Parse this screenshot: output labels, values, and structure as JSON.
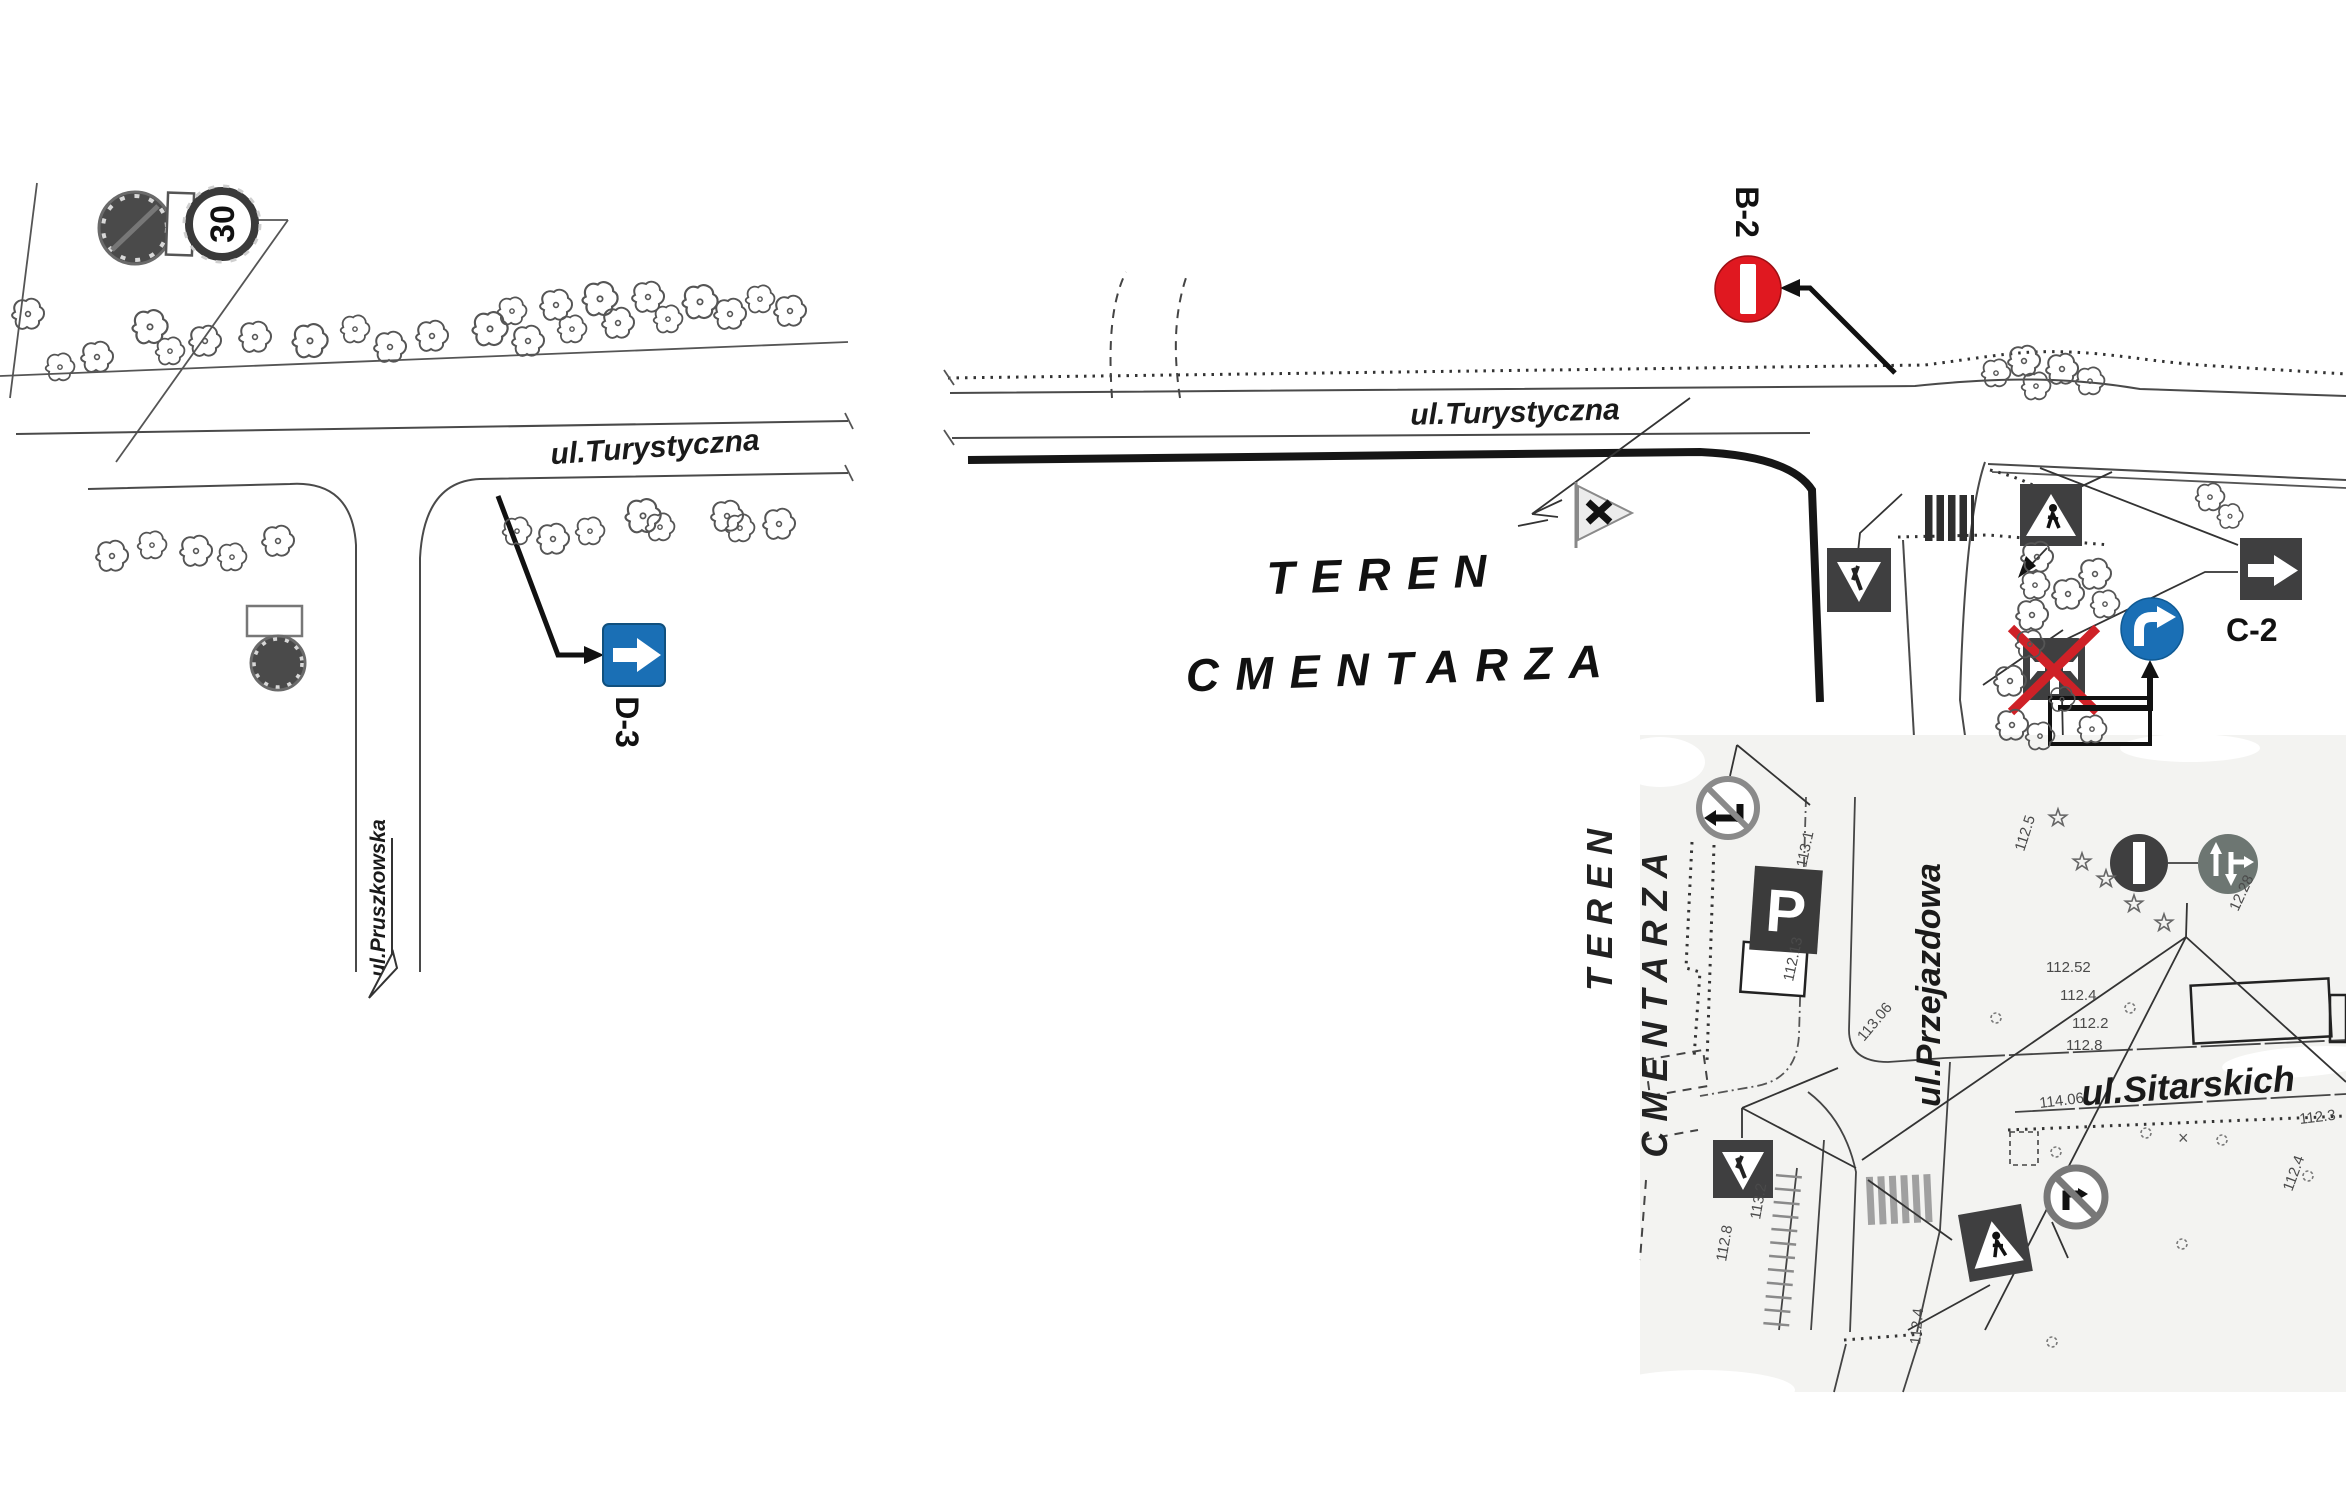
{
  "streets": {
    "turystyczna_left": "ul.Turystyczna",
    "turystyczna_right": "ul.Turystyczna",
    "pruszkowska": "ul.Pruszkowska",
    "przejazdowa": "ul.Przejazdowa",
    "sitarskich": "ul.Sitarskich"
  },
  "area": {
    "line1": "TEREN",
    "line2": "CMENTARZA"
  },
  "inset_area": {
    "line1": "TEREN",
    "line2": "CMENTARZA"
  },
  "signs": {
    "d3": {
      "code": "D-3"
    },
    "b2": {
      "code": "B-2"
    },
    "c2": {
      "code": "C-2"
    },
    "speed": {
      "value": "30"
    },
    "parking": {
      "letter": "P"
    }
  },
  "colors": {
    "sign_blue": "#1a6fb5",
    "sign_red": "#e01820",
    "cross_red": "#cf2127",
    "dark_sign": "#3f3f40",
    "grey_sign": "#6d7672"
  },
  "elevations": [
    {
      "t": "113.1",
      "x": 1806,
      "y": 868,
      "r": -78
    },
    {
      "t": "112.13",
      "x": 1793,
      "y": 982,
      "r": -78
    },
    {
      "t": "113.06",
      "x": 1864,
      "y": 1042,
      "r": -50
    },
    {
      "t": "112.5",
      "x": 2024,
      "y": 852,
      "r": -72
    },
    {
      "t": "12.28",
      "x": 2238,
      "y": 912,
      "r": -65
    },
    {
      "t": "112.52",
      "x": 2046,
      "y": 972,
      "r": 0
    },
    {
      "t": "112.4",
      "x": 2060,
      "y": 1000,
      "r": 0
    },
    {
      "t": "112.2",
      "x": 2072,
      "y": 1028,
      "r": 0
    },
    {
      "t": "112.8",
      "x": 2066,
      "y": 1050,
      "r": 0
    },
    {
      "t": "114.06",
      "x": 2040,
      "y": 1108,
      "r": -7
    },
    {
      "t": "112.3",
      "x": 2300,
      "y": 1124,
      "r": -7
    },
    {
      "t": "112.4",
      "x": 2292,
      "y": 1192,
      "r": -70
    },
    {
      "t": "112.8",
      "x": 1726,
      "y": 1262,
      "r": -80
    },
    {
      "t": "113.2",
      "x": 1760,
      "y": 1220,
      "r": -80
    },
    {
      "t": "112.4",
      "x": 1920,
      "y": 1345,
      "r": -85
    }
  ],
  "stars": [
    {
      "x": 2058,
      "y": 818
    },
    {
      "x": 2082,
      "y": 862
    },
    {
      "x": 2106,
      "y": 879
    },
    {
      "x": 2134,
      "y": 904
    },
    {
      "x": 2164,
      "y": 923
    }
  ],
  "bushes": [
    {
      "x": 2130,
      "y": 1008
    },
    {
      "x": 1996,
      "y": 1018
    },
    {
      "x": 2146,
      "y": 1133
    },
    {
      "x": 2222,
      "y": 1140
    },
    {
      "x": 2056,
      "y": 1152
    },
    {
      "x": 2308,
      "y": 1176
    },
    {
      "x": 2182,
      "y": 1244
    },
    {
      "x": 2052,
      "y": 1342
    }
  ],
  "xmarks": [
    {
      "x": 2178,
      "y": 1144
    }
  ],
  "trees": [
    {
      "x": 28,
      "y": 315,
      "s": 1.0
    },
    {
      "x": 60,
      "y": 368,
      "s": 0.9
    },
    {
      "x": 97,
      "y": 358,
      "s": 1.0
    },
    {
      "x": 150,
      "y": 328,
      "s": 1.1
    },
    {
      "x": 170,
      "y": 352,
      "s": 0.9
    },
    {
      "x": 205,
      "y": 342,
      "s": 1.0
    },
    {
      "x": 255,
      "y": 338,
      "s": 1.0
    },
    {
      "x": 310,
      "y": 342,
      "s": 1.1
    },
    {
      "x": 355,
      "y": 330,
      "s": 0.9
    },
    {
      "x": 390,
      "y": 348,
      "s": 1.0
    },
    {
      "x": 432,
      "y": 337,
      "s": 1.0
    },
    {
      "x": 490,
      "y": 330,
      "s": 1.1
    },
    {
      "x": 512,
      "y": 312,
      "s": 0.9
    },
    {
      "x": 528,
      "y": 342,
      "s": 1.0
    },
    {
      "x": 556,
      "y": 306,
      "s": 1.0
    },
    {
      "x": 572,
      "y": 330,
      "s": 0.9
    },
    {
      "x": 600,
      "y": 300,
      "s": 1.1
    },
    {
      "x": 618,
      "y": 324,
      "s": 1.0
    },
    {
      "x": 648,
      "y": 298,
      "s": 1.0
    },
    {
      "x": 668,
      "y": 320,
      "s": 0.9
    },
    {
      "x": 700,
      "y": 303,
      "s": 1.1
    },
    {
      "x": 730,
      "y": 315,
      "s": 1.0
    },
    {
      "x": 760,
      "y": 300,
      "s": 0.9
    },
    {
      "x": 790,
      "y": 312,
      "s": 1.0
    },
    {
      "x": 112,
      "y": 557,
      "s": 1.0
    },
    {
      "x": 152,
      "y": 546,
      "s": 0.9
    },
    {
      "x": 196,
      "y": 552,
      "s": 1.0
    },
    {
      "x": 232,
      "y": 558,
      "s": 0.9
    },
    {
      "x": 278,
      "y": 542,
      "s": 1.0
    },
    {
      "x": 517,
      "y": 532,
      "s": 0.9
    },
    {
      "x": 553,
      "y": 540,
      "s": 1.0
    },
    {
      "x": 590,
      "y": 532,
      "s": 0.9
    },
    {
      "x": 643,
      "y": 517,
      "s": 1.1
    },
    {
      "x": 660,
      "y": 528,
      "s": 0.9
    },
    {
      "x": 727,
      "y": 517,
      "s": 1.0
    },
    {
      "x": 740,
      "y": 529,
      "s": 0.9
    },
    {
      "x": 779,
      "y": 525,
      "s": 1.0
    },
    {
      "x": 1996,
      "y": 374,
      "s": 0.9
    },
    {
      "x": 2024,
      "y": 362,
      "s": 1.0
    },
    {
      "x": 2036,
      "y": 387,
      "s": 0.9
    },
    {
      "x": 2062,
      "y": 370,
      "s": 1.0
    },
    {
      "x": 2090,
      "y": 382,
      "s": 0.9
    },
    {
      "x": 2210,
      "y": 498,
      "s": 0.9
    },
    {
      "x": 2230,
      "y": 517,
      "s": 0.8
    },
    {
      "x": 2037,
      "y": 558,
      "s": 1.0
    },
    {
      "x": 2095,
      "y": 575,
      "s": 1.0
    },
    {
      "x": 2035,
      "y": 586,
      "s": 0.9
    },
    {
      "x": 2068,
      "y": 595,
      "s": 1.0
    },
    {
      "x": 2105,
      "y": 605,
      "s": 0.9
    },
    {
      "x": 2032,
      "y": 616,
      "s": 1.0
    },
    {
      "x": 2030,
      "y": 645,
      "s": 0.9
    },
    {
      "x": 2010,
      "y": 682,
      "s": 1.0
    },
    {
      "x": 2012,
      "y": 726,
      "s": 1.0
    },
    {
      "x": 2040,
      "y": 737,
      "s": 0.9
    },
    {
      "x": 2062,
      "y": 700,
      "s": 0.8
    },
    {
      "x": 2092,
      "y": 730,
      "s": 0.9
    }
  ]
}
